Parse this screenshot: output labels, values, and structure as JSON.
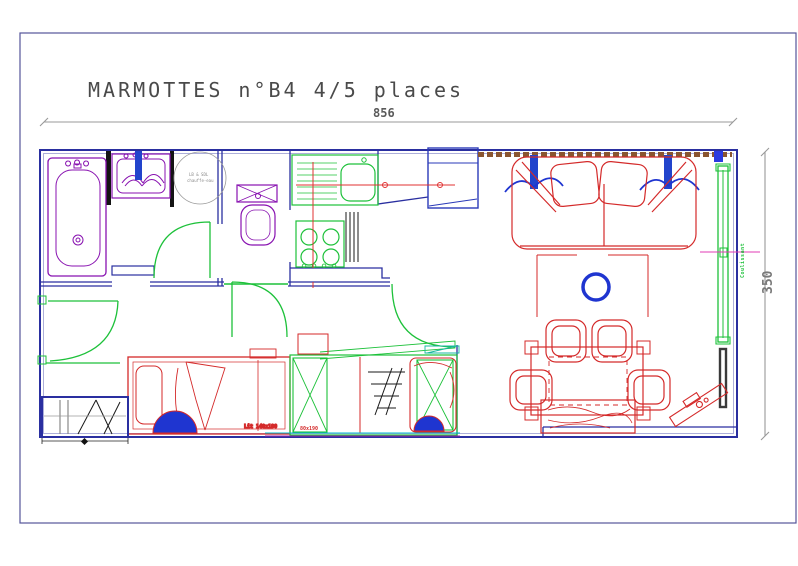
{
  "title": "MARMOTTES n°B4 4/5 places",
  "dimensions": {
    "width": "856",
    "height": "350"
  },
  "labels": {
    "water_heater_1": "LB & SDL",
    "water_heater_2": "chauffe-eau",
    "double_bed": "Lit 140x190",
    "single_bed": "80x190",
    "sliding_door": "Coulissant"
  },
  "colors": {
    "wall": "#2a2fa0",
    "fixture_purple": "#8812b0",
    "door_green": "#1dc13a",
    "furniture_red": "#d42a2a",
    "pipe_red": "#e03030",
    "accent_blue": "#1f35d0",
    "window_band_brown": "#8a5530",
    "dimension_gray": "#999999",
    "centerline_magenta": "#e23bb4",
    "panel_dark": "#3a3a3a"
  }
}
